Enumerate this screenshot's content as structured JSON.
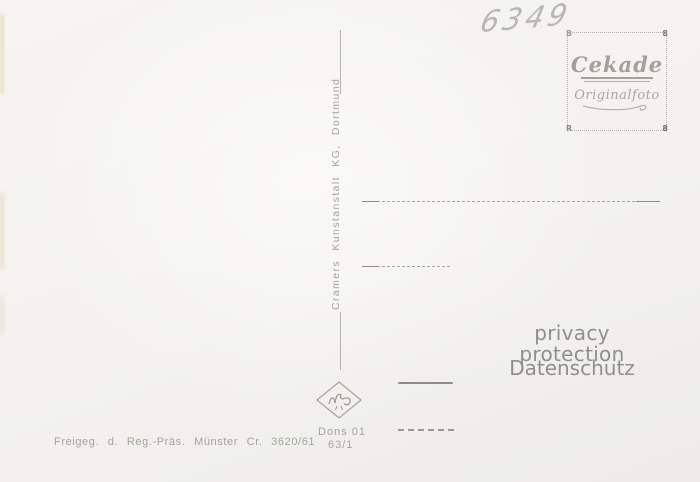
{
  "postcard": {
    "handwritten_number": "6349",
    "stamp_box": {
      "brand": "Cekade",
      "subtitle": "Originalfoto",
      "corner_marks": {
        "top_left": "B",
        "top_right": "8",
        "bottom_left": "R",
        "bottom_right": "8"
      }
    },
    "publisher_vertical_text": "Cramers Kunstanstalt KG, Dortmund",
    "watermark": {
      "line1": "privacy protection",
      "line2": "Datenschutz"
    },
    "approval_text": "Freigeg. d. Reg.-Präs. Münster Cr. 3620/61",
    "order_number": {
      "line1": "Dons 01",
      "line2": "63/1"
    },
    "colors": {
      "paper": "#f3f2ef",
      "print_gray": "#a5a39d",
      "watermark_gray": "#8f8f8f",
      "pencil_gray": "#b8b7b4",
      "dark_line_gray": "#8f8d89"
    }
  }
}
